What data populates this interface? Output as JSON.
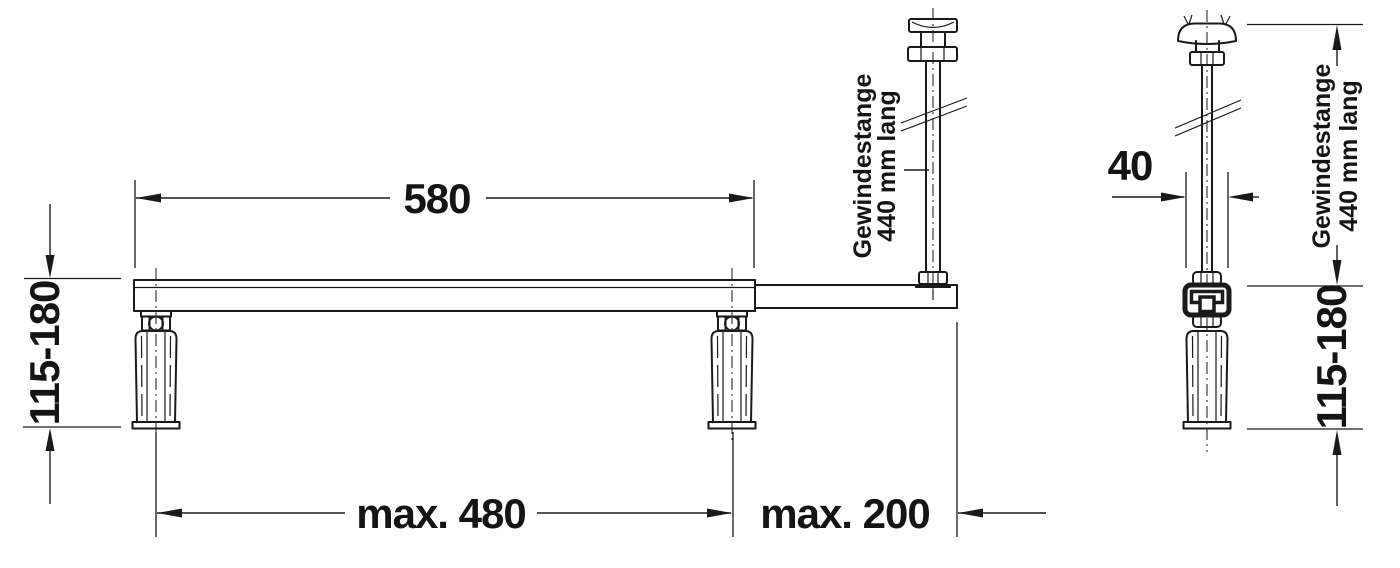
{
  "colors": {
    "line": "#1a1a1a",
    "background": "#ffffff"
  },
  "views": {
    "front": {
      "dim_length": "580",
      "dim_foot_span": "max. 480",
      "dim_overhang": "max. 200",
      "dim_height": "115-180",
      "rod_note_line1": "Gewindestange",
      "rod_note_line2": "440 mm lang"
    },
    "side": {
      "dim_width": "40",
      "dim_height": "115-180",
      "rod_note_line1": "Gewindestange",
      "rod_note_line2": "440 mm lang"
    }
  }
}
